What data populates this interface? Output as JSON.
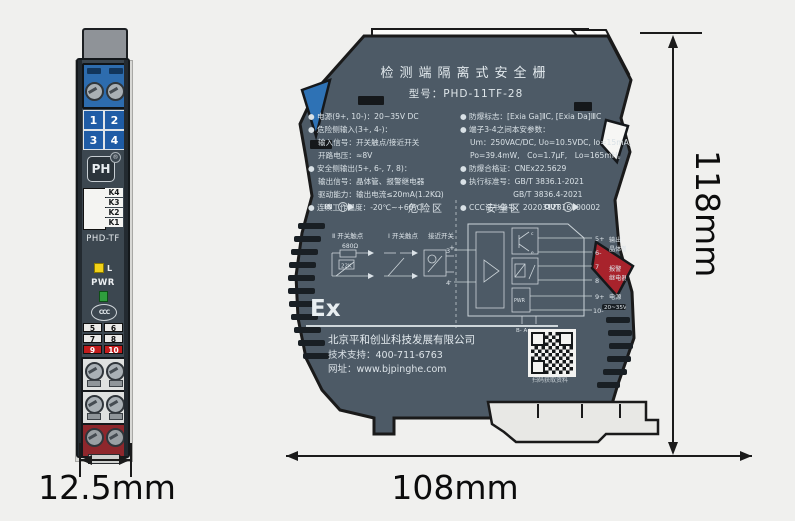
{
  "front_view": {
    "grid_numbers": [
      "1",
      "2",
      "3",
      "4"
    ],
    "logo": "PH",
    "reg_mark": "®",
    "k_labels": [
      "K4",
      "K3",
      "K2",
      "K1"
    ],
    "model": "PHD-TF",
    "led_label": "L",
    "pwr_label": "PWR",
    "cert_mark": "CCC",
    "plates": [
      [
        "5",
        "6"
      ],
      [
        "7",
        "8"
      ],
      [
        "9",
        "10"
      ]
    ]
  },
  "side_view": {
    "title": "检测端隔离式安全栅",
    "model_line": "型号：PHD-11TF-28",
    "specs_left": [
      "● 电源(9+, 10-)：20~35V DC",
      "● 危险侧输入(3+, 4-)：",
      "　 输入信号：开关触点/接近开关",
      "　 开路电压：≈8V",
      "● 安全侧输出(5+, 6-, 7, 8)：",
      "　 输出信号：晶体管、报警继电器",
      "　 驱动能力：输出电流≤20mA(1.2KΩ)",
      "● 连续工作温度：-20℃~+60℃"
    ],
    "specs_right": [
      "● 防爆标志：[Exia Ga]ⅡC, [Exia Da]ⅢC",
      "● 端子3-4之间本安参数：",
      "　 Um：250VAC/DC, Uo=10.5VDC, Io=15mA,",
      "　 Po=39.4mW,　Co=1.7μF,　Lo=165mH。",
      "● 防爆合格证：CNEx22.5629",
      "● 执行标准号：GB/T 3836.1-2021",
      "　　　　　　　GB/T 3836.4-2021",
      "● CCC证书编号：2020312316000002"
    ],
    "diagram": {
      "in_label": "IN",
      "out_label": "OUT",
      "hazard_zone": "危险区",
      "safe_zone": "安全区",
      "sym1_label": "Ⅱ 开关触点",
      "sym1_r1": "680Ω",
      "sym1_r2": "22K",
      "sym2_label": "Ⅰ 开关触点",
      "sym3_label": "接近开关",
      "sym3_plus": "+",
      "sym3_minus": "-",
      "t3": "3",
      "t4": "4",
      "t5": "5+",
      "t6": "6-",
      "t7": "7",
      "t8": "8",
      "t9": "9+",
      "t10": "10-",
      "tr_c": "c",
      "tr_e": "e",
      "out1_l1": "输出",
      "out1_l2": "晶体管",
      "out2_l1": "报警",
      "out2_l2": "继电器",
      "out3_l1": "电源",
      "out3_l2": "20~35VDC",
      "pwr_box": "PWR",
      "bottom_taps": "B-  A+"
    },
    "ex_mark": "Ex",
    "company_name": "北京平和创业科技发展有限公司",
    "support_line": "技术支持：400-711-6763",
    "website_line": "网址：www.bjpinghe.com",
    "qr_caption": "扫码获取资料"
  },
  "dimensions": {
    "front_width": "12.5mm",
    "side_width": "108mm",
    "height": "118mm"
  },
  "colors": {
    "body": "#4d5a66",
    "front_body": "#3c4750",
    "terminal_blue": "#2d6cae",
    "terminal_red": "#a8232c",
    "plate_red": "#c31c1c",
    "background": "#f0f0ee",
    "text_light": "#dfe6ea",
    "dimension_ink": "#1b1b1b"
  }
}
